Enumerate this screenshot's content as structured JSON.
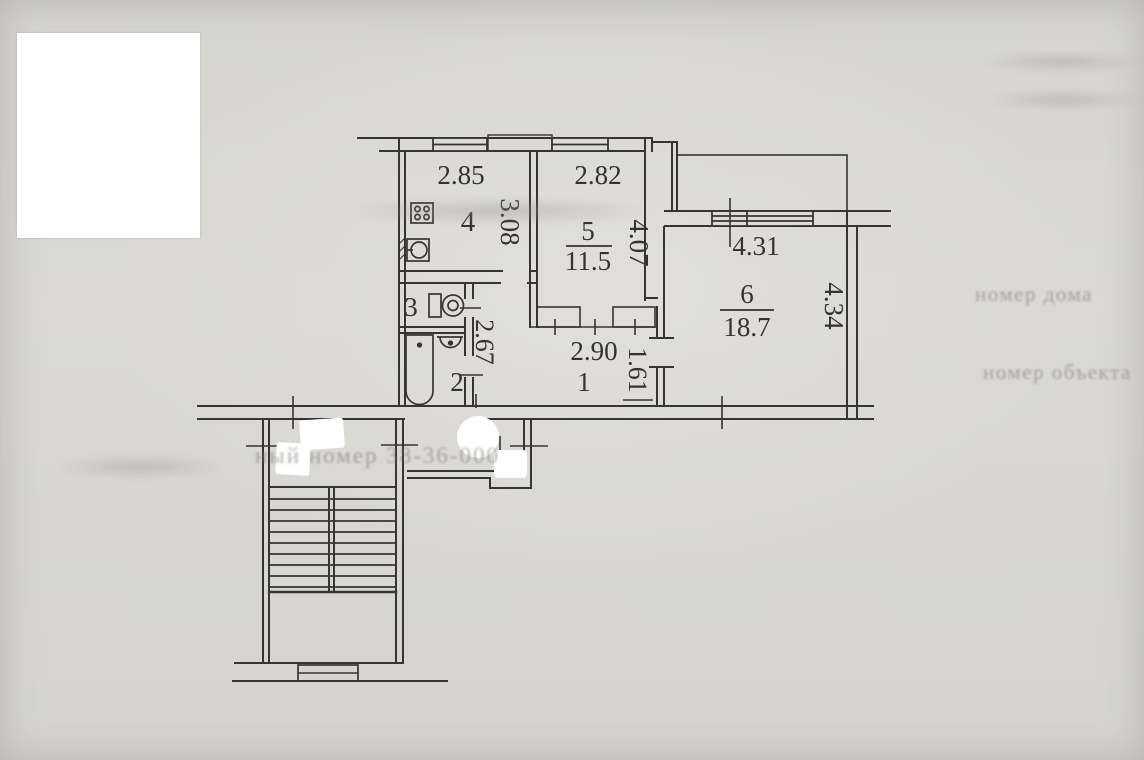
{
  "document": {
    "kind": "scanned BTI apartment floor plan",
    "paper_color": "#d8d6d2",
    "ink_color": "#37352f"
  },
  "labels": {
    "dim_kitchen_w": "2.85",
    "dim_kitchen_h": "3.08",
    "room_kitchen": "4",
    "dim_r5_w": "2.82",
    "room_r5": "5",
    "area_r5": "11.5",
    "dim_r5_h": "4.07",
    "dim_r6_w": "4.31",
    "room_r6": "6",
    "area_r6": "18.7",
    "dim_r6_h": "4.34",
    "room_wc": "3",
    "room_bath": "2",
    "dim_corridor": "2.67",
    "dim_hall_w": "2.90",
    "room_hall": "1",
    "dim_hall_h": "1.61"
  },
  "faint_text": {
    "house_number_label": "номер дома",
    "object_number_label": "номер объекта",
    "inventory_line": "ный номер             38-36-000"
  },
  "icons": {
    "stove-icon": "svg-shape: square with 4 burners",
    "kitchen-sink-icon": "svg-shape: square with basin circle",
    "toilet-icon": "svg-shape: cistern + bowl",
    "bath-sink-icon": "svg-shape: half-round washbasin",
    "bathtub-icon": "svg-shape: rounded tub",
    "stairs-icon": "svg-shape: stair treads with stringer",
    "window-icon": "svg-shape: triple-line window symbol"
  }
}
